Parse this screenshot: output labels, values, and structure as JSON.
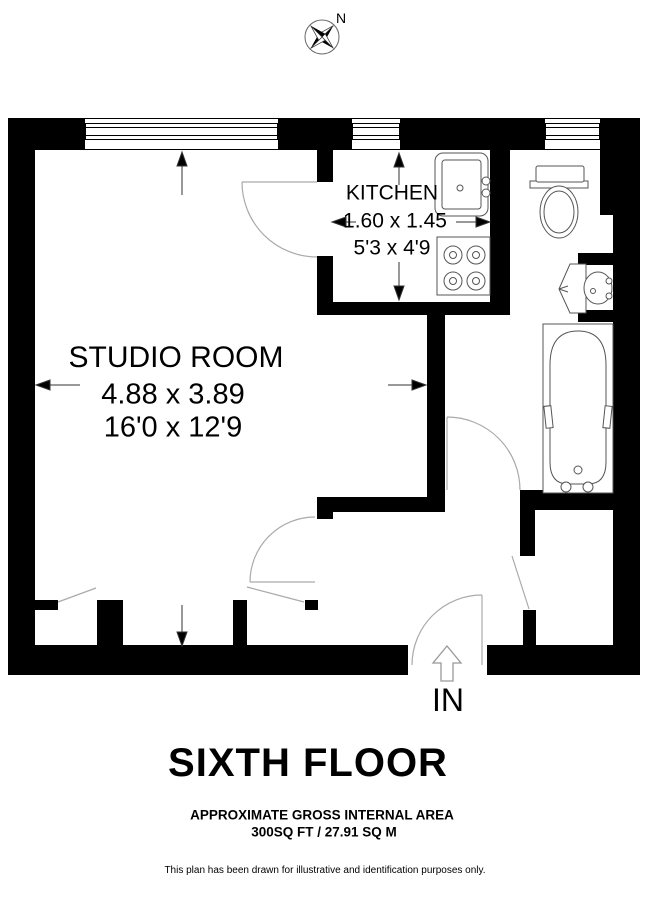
{
  "compass": {
    "north_label": "N"
  },
  "rooms": {
    "kitchen": {
      "name": "KITCHEN",
      "dimensions_metric": "1.60 x 1.45",
      "dimensions_imperial": "5'3 x 4'9"
    },
    "studio": {
      "name": "STUDIO ROOM",
      "dimensions_metric": "4.88 x 3.89",
      "dimensions_imperial": "16'0 x 12'9"
    }
  },
  "entrance": {
    "label": "IN"
  },
  "footer": {
    "floor_title": "SIXTH FLOOR",
    "area_line1": "APPROXIMATE GROSS INTERNAL AREA",
    "area_line2": "300SQ FT / 27.91 SQ M",
    "disclaimer": "This plan has been drawn for illustrative and identification purposes only."
  },
  "colors": {
    "wall": "#000000",
    "door_arc": "#aaaaaa",
    "fixture_line": "#555555",
    "background": "#ffffff"
  }
}
